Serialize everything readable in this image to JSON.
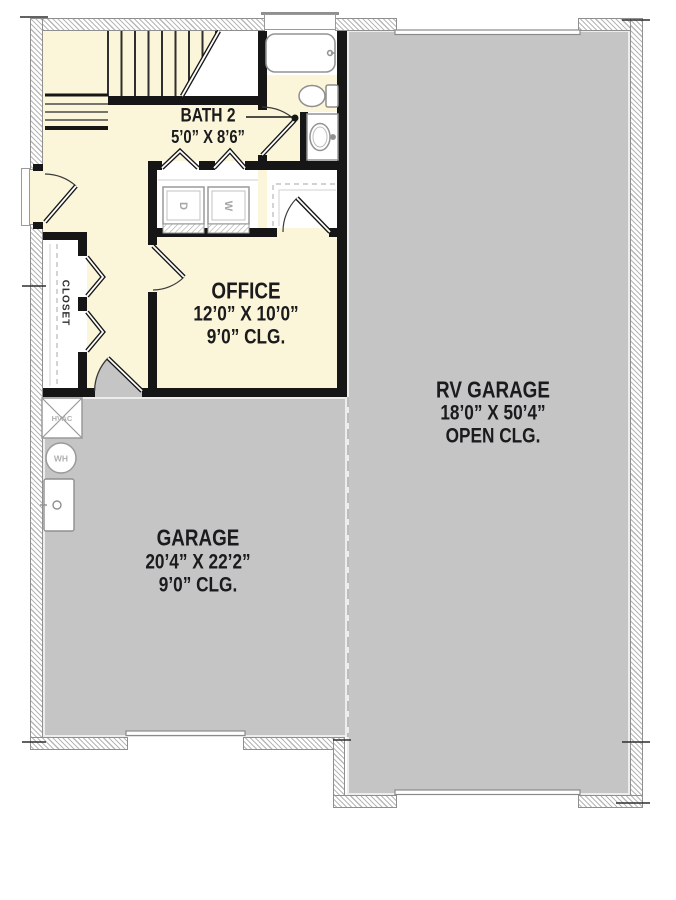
{
  "plan": {
    "title": "Garage level floor plan",
    "rooms": {
      "bath2": {
        "name": "BATH 2",
        "dims": "5’0” X 8’6”"
      },
      "office": {
        "name": "OFFICE",
        "dims": "12’0” X 10’0”",
        "ceiling": "9’0” CLG."
      },
      "garage": {
        "name": "GARAGE",
        "dims": "20’4” X 22’2”",
        "ceiling": "9’0” CLG."
      },
      "rv_garage": {
        "name": "RV GARAGE",
        "dims": "18’0” X 50’4”",
        "ceiling": "OPEN CLG."
      },
      "closet": {
        "name": "CLOSET"
      }
    },
    "fixtures": {
      "hvac": "HVAC",
      "water_heater": "WH",
      "washer": "W",
      "dryer": "D"
    },
    "colors": {
      "floor": "#FBF6D9",
      "garage_floor": "#C5C5C6",
      "wall": "#161616"
    }
  }
}
